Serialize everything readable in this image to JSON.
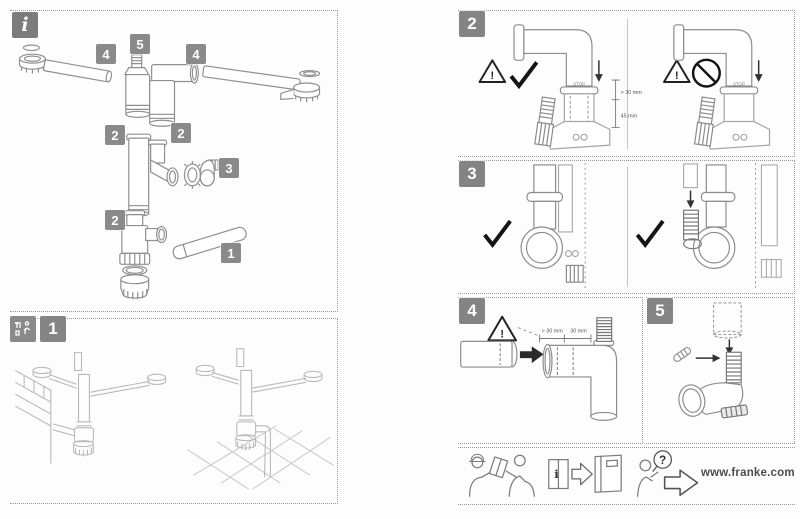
{
  "symbols": {
    "warning": "!",
    "info": "i",
    "question": "?"
  },
  "parts_overview": {
    "badge": "i",
    "part_numbers": {
      "p4a": "4",
      "p5": "5",
      "p4b": "4",
      "p2a": "2",
      "p2b": "2",
      "p3": "3",
      "p2c": "2",
      "p1": "1"
    }
  },
  "steps": {
    "one": {
      "number": "1"
    },
    "two": {
      "number": "2",
      "stop_label_left": "STOP",
      "stop_label_right": "STOP",
      "dim_upper": "> 30 mm",
      "dim_lower": "45 mm"
    },
    "three": {
      "number": "3"
    },
    "four": {
      "number": "4",
      "dim_insert_min": "> 30 mm",
      "dim_insert": "30 mm"
    },
    "five": {
      "number": "5"
    }
  },
  "footer": {
    "website": "www.franke.com"
  }
}
